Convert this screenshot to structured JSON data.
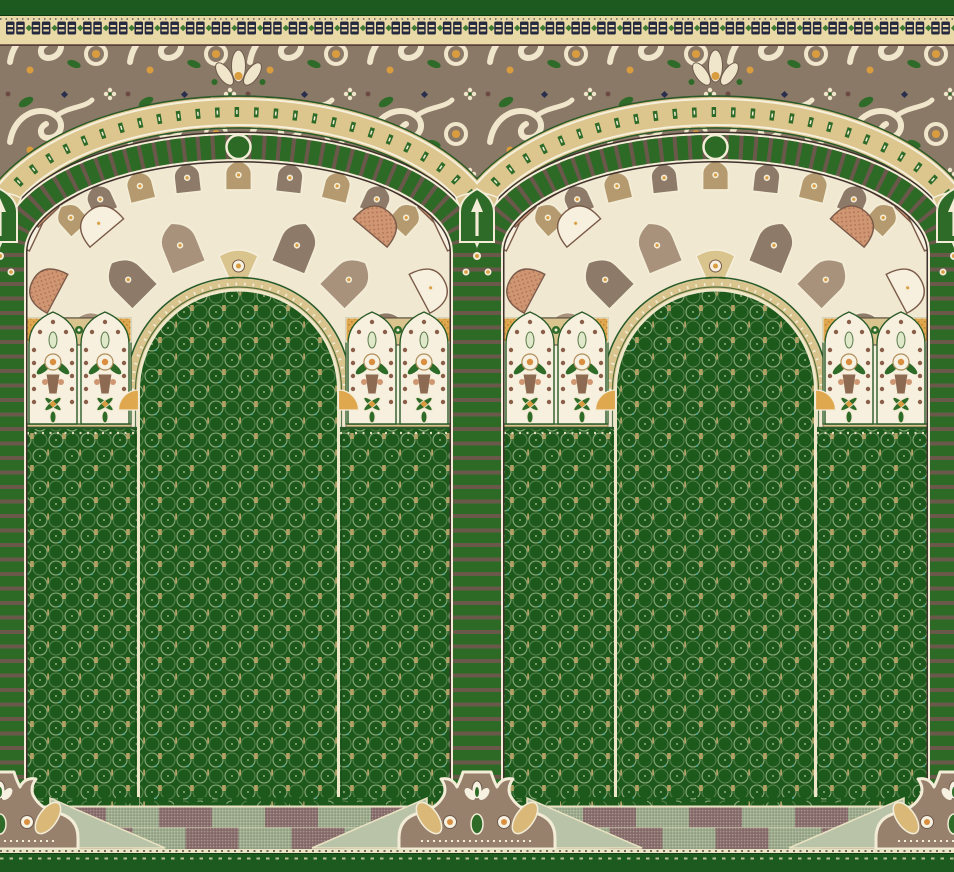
{
  "artwork": {
    "kind": "prayer-rug-carpet-pattern",
    "arch_count": 2,
    "motifs": [
      "mihrab-arch",
      "ribbed-column",
      "rosette-arc-band",
      "arabesque-frieze",
      "muqarnas-fan-spandrel",
      "pier-flower-panels",
      "prayer-niche-field",
      "checkerboard-floor",
      "column-base-crown"
    ]
  },
  "canvas": {
    "width": 954,
    "height": 872
  },
  "palette": {
    "strip_green": "#1d5a1f",
    "hair_dark": "#0f3a12",
    "band_cream": "#e9d9a6",
    "glyph_navy": "#262a40",
    "glyph_green": "#3f7a33",
    "line_maroon": "#5a3f3a",
    "taupe": "#8b7967",
    "taupe_dark": "#6e5b4c",
    "scroll_cream": "#f0e6cc",
    "accent_orange": "#d99c3f",
    "leaf_green": "#2e6b28",
    "accent_navy": "#2a2f4e",
    "accent_maroon": "#6e4a44",
    "tan_band": "#dcc68e",
    "band_edge_cream": "#f5efdc",
    "dark_green_line": "#2a5a28",
    "rope_green": "#2d6a26",
    "rope_cream": "#f3ecd6",
    "rope_gap": "#6a594b",
    "rope_shadow": "#3f312b",
    "spandrel_cream": "#f1e8d2",
    "fan_terracotta": "#cf9672",
    "fan_terracotta_dk": "#b2725a",
    "fan_cream": "#f7f0de",
    "fan_brown": "#8d7a68",
    "fan_tan": "#b49a6e",
    "fan_outline": "#7a5a48",
    "dome_tan": "#d9c48e",
    "field_green": "#1e591c",
    "field_dark": "#1a4f19",
    "field_trace": "#a4b88f",
    "field_tan": "#c2a96c",
    "field_teal": "#3f9e8a",
    "niche_line": "#efe7c9",
    "pier_cream": "#f5efdd",
    "dot_brown": "#8a5f4a",
    "flower_white": "#f6f1e1",
    "flower_center": "#d98f3f",
    "vase_brown": "#8d6b52",
    "pale_leaf": "#dfe8c8",
    "hatch_orange": "#e0a84e",
    "hatch_orange_dk": "#c08638",
    "floor_sage": "#9fae90",
    "floor_mauve": "#8b7170",
    "floor_light": "#b9c3a8",
    "floor_line": "#e9e2c2",
    "base_taupe": "#97806c",
    "base_tan": "#d9b878",
    "bottom_dash_cream": "#d9d2a8"
  },
  "geometry": {
    "cell_width": 477,
    "arch_center_x": 238.5,
    "rope_x": [
      12,
      465
    ],
    "spring_y": 252,
    "rope_rx": 226.5,
    "rope_ry": 105,
    "tan_rx": 254,
    "tan_ry": 140,
    "dome_cx": 238.5,
    "dome_cy": 390,
    "dome_r": 100,
    "niche_left": 138.5,
    "niche_right": 338.5,
    "spandrel_bottom": 428,
    "pier_left_x": 27,
    "pier_right_x": 346,
    "pier_width": 104,
    "pier_top": 318,
    "pier_bottom": 424,
    "bands": {
      "top_strip": [
        0,
        16
      ],
      "glyph_band": [
        16,
        46
      ],
      "arabesque_band": [
        46,
        302
      ],
      "field_top": 420,
      "field_bottom": 808,
      "floor": [
        806,
        849
      ],
      "floor_line": [
        849,
        853
      ],
      "bottom_strip": [
        853,
        872
      ]
    },
    "glyph_count": 37,
    "bases_x": [
      0,
      477,
      954
    ],
    "rib_dash": "10.5 4",
    "row_a": {
      "a": 205,
      "b": 92,
      "from": -78,
      "step": 13,
      "count": 13,
      "w": 40,
      "h": 26
    },
    "row_b": {
      "a": 170,
      "b": 62,
      "from": -68,
      "step": 17,
      "count": 9,
      "w": 26,
      "h": 30
    },
    "row_c_angles": [
      -80,
      -62,
      -40,
      40,
      62,
      80
    ],
    "row_c_r": 205,
    "ring_angles": [
      -68,
      -45,
      -22,
      22,
      45,
      68
    ],
    "ring_r": 132
  }
}
